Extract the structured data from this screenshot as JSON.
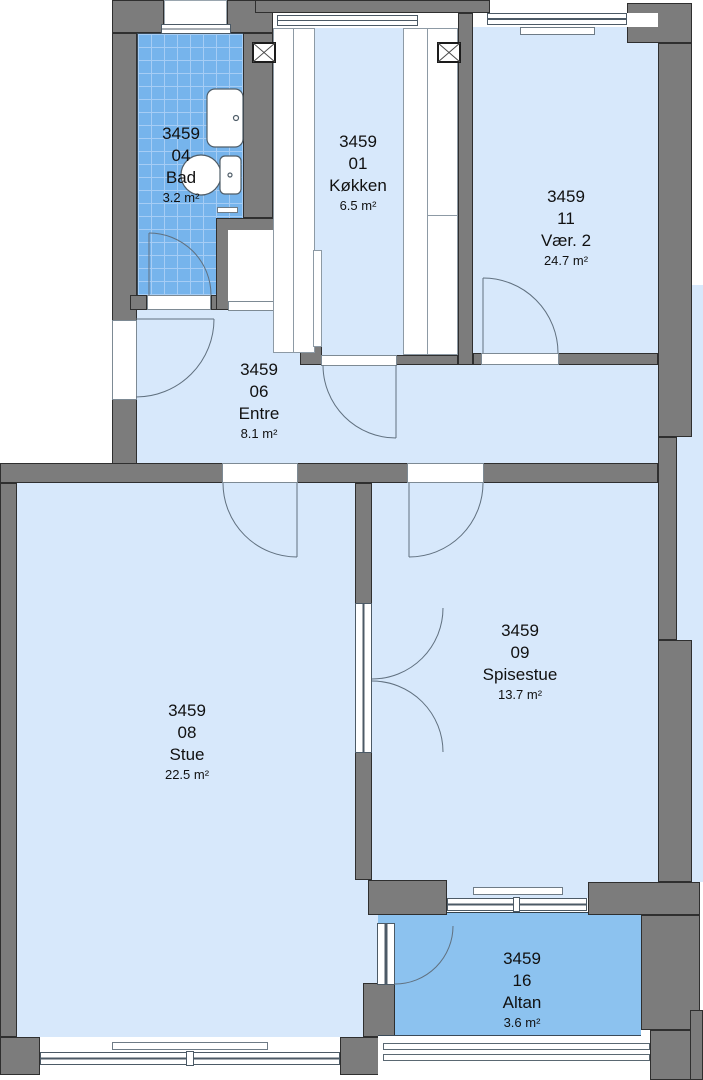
{
  "plan_title": "Apartment floor plan 3459",
  "rooms": [
    {
      "id": "3459",
      "number": "04",
      "name": "Bad",
      "area": "3.2 m²"
    },
    {
      "id": "3459",
      "number": "01",
      "name": "Køkken",
      "area": "6.5 m²"
    },
    {
      "id": "3459",
      "number": "11",
      "name": "Vær. 2",
      "area": "24.7 m²"
    },
    {
      "id": "3459",
      "number": "06",
      "name": "Entre",
      "area": "8.1 m²"
    },
    {
      "id": "3459",
      "number": "08",
      "name": "Stue",
      "area": "22.5 m²"
    },
    {
      "id": "3459",
      "number": "09",
      "name": "Spisestue",
      "area": "13.7 m²"
    },
    {
      "id": "3459",
      "number": "16",
      "name": "Altan",
      "area": "3.6 m²"
    }
  ],
  "colors": {
    "wall": "#7c7c7c",
    "wall_outline": "#2f2f2f",
    "room_fill": "#d7e8fb",
    "wet_room_fill": "#76b4ec",
    "balcony_fill": "#8cc2ef",
    "background": "#ffffff"
  },
  "symbols": [
    "door-swing-arc",
    "window",
    "ventilation-shaft",
    "radiator",
    "sink",
    "toilet",
    "balcony-railing",
    "kitchen-counter",
    "closet"
  ]
}
